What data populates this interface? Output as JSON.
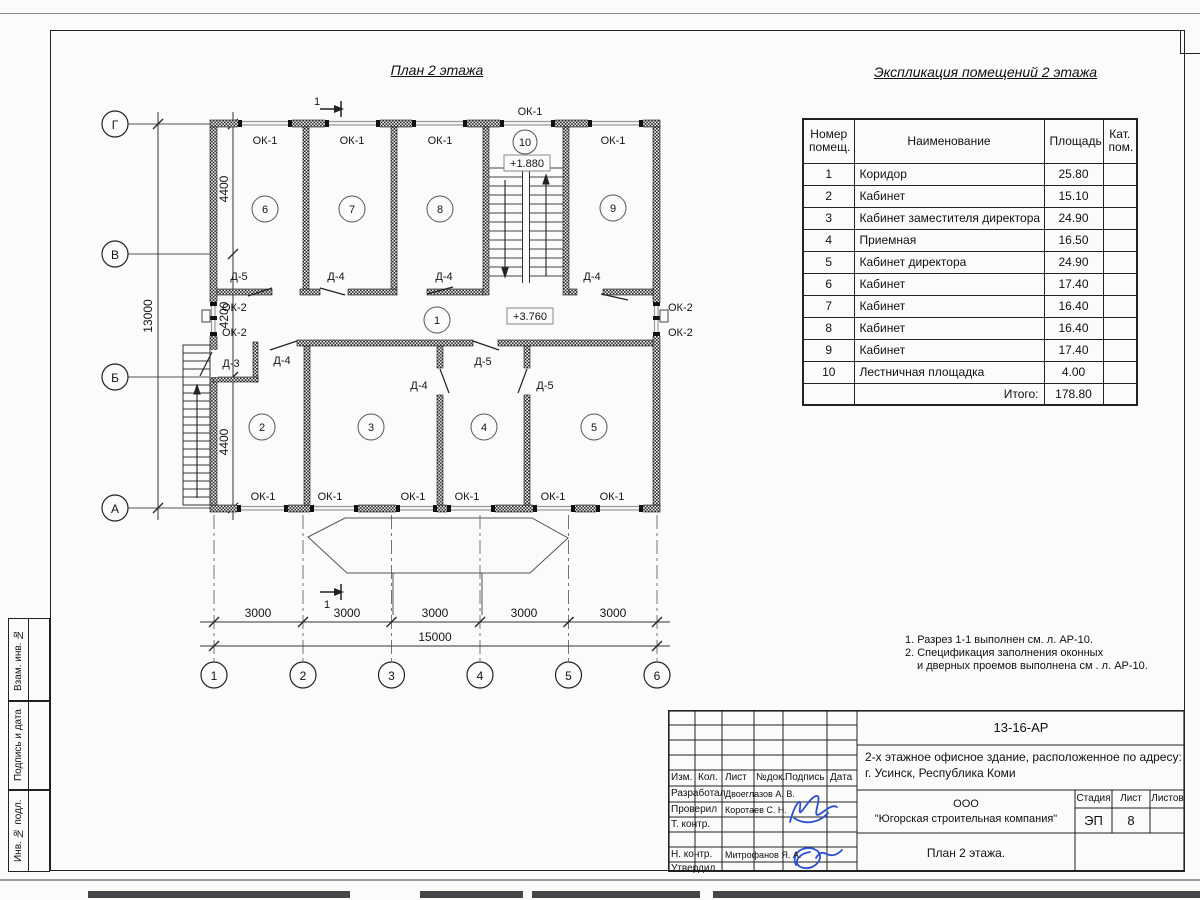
{
  "plan": {
    "title": "План 2 этажа",
    "section_label": "1",
    "axis_letters": [
      "Г",
      "В",
      "Б",
      "А"
    ],
    "axis_numbers": [
      "1",
      "2",
      "3",
      "4",
      "5",
      "6"
    ],
    "v_dims": [
      "4400",
      "4200",
      "4400",
      "13000"
    ],
    "h_dims": [
      "3000",
      "3000",
      "3000",
      "3000",
      "3000",
      "15000"
    ],
    "room_numbers": [
      "1",
      "2",
      "3",
      "4",
      "5",
      "6",
      "7",
      "8",
      "9",
      "10"
    ],
    "levels": [
      "+1.880",
      "+3.760"
    ],
    "ok1": [
      "ОК-1",
      "ОК-1",
      "ОК-1",
      "ОК-1",
      "ОК-1",
      "ОК-1",
      "ОК-1",
      "ОК-1",
      "ОК-1",
      "ОК-1",
      "ОК-1"
    ],
    "ok2": [
      "ОК-2",
      "ОК-2",
      "ОК-2",
      "ОК-2"
    ],
    "doors_top": [
      "Д-5",
      "Д-4",
      "Д-4",
      "Д-4"
    ],
    "doors_bottom": [
      "Д-3",
      "Д-4",
      "Д-4",
      "Д-5",
      "Д-5"
    ]
  },
  "table": {
    "title": "Экспликация помещений 2 этажа",
    "header": {
      "num1": "Номер",
      "num2": "помещ.",
      "name": "Наименование",
      "area": "Площадь",
      "cat1": "Кат.",
      "cat2": "пом."
    },
    "rows": [
      {
        "n": "1",
        "name": "Коридор",
        "area": "25.80"
      },
      {
        "n": "2",
        "name": "Кабинет",
        "area": "15.10"
      },
      {
        "n": "3",
        "name": "Кабинет заместителя директора",
        "area": "24.90"
      },
      {
        "n": "4",
        "name": "Приемная",
        "area": "16.50"
      },
      {
        "n": "5",
        "name": "Кабинет директора",
        "area": "24.90"
      },
      {
        "n": "6",
        "name": "Кабинет",
        "area": "17.40"
      },
      {
        "n": "7",
        "name": "Кабинет",
        "area": "16.40"
      },
      {
        "n": "8",
        "name": "Кабинет",
        "area": "16.40"
      },
      {
        "n": "9",
        "name": "Кабинет",
        "area": "17.40"
      },
      {
        "n": "10",
        "name": "Лестничная площадка",
        "area": "4.00"
      }
    ],
    "total_label": "Итого:",
    "total": "178.80"
  },
  "notes": {
    "line1": "1. Разрез 1-1 выполнен см. л. АР-10.",
    "line2": "2. Спецификация заполнения оконных",
    "line3": "и дверных проемов выполнена см . л. АР-10."
  },
  "titleblock": {
    "doc_code": "13-16-АР",
    "object_line1": "2-х этажное офисное здание, расположенное по адресу:",
    "object_line2": "г. Усинск, Республика Коми",
    "company_line1": "ООО",
    "company_line2": "\"Югорская строительная компания\"",
    "sheet_title": "План 2 этажа.",
    "stage_label": "Стадия",
    "sheet_label": "Лист",
    "sheets_label": "Листов",
    "stage": "ЭП",
    "sheet_no": "8",
    "cols": [
      "Изм.",
      "Кол.",
      "Лист",
      "№док.",
      "Подпись",
      "Дата"
    ],
    "rows": [
      {
        "role": "Разработал",
        "name": "Двоеглазов А. В."
      },
      {
        "role": "Проверил",
        "name": "Коротаев С. Н."
      },
      {
        "role": "Т. контр.",
        "name": ""
      },
      {
        "role": "",
        "name": ""
      },
      {
        "role": "Н. контр.",
        "name": "Митрофанов Я. А."
      },
      {
        "role": "Утвердил",
        "name": ""
      }
    ]
  },
  "stamp_side": {
    "labels": [
      "Взам. инв. №",
      "Подпись и дата",
      "Инв. № подл."
    ]
  }
}
